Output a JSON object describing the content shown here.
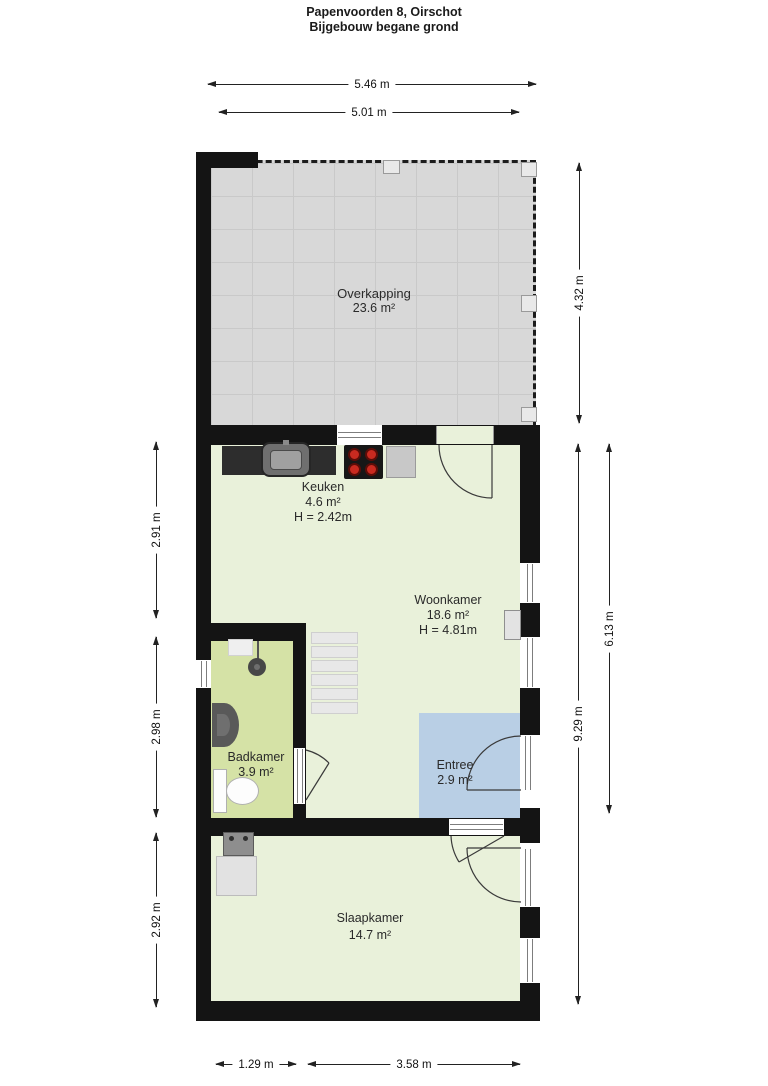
{
  "title": {
    "line1": "Papenvoorden 8, Oirschot",
    "line2": "Bijgebouw begane grond"
  },
  "rooms": {
    "overkapping": {
      "name": "Overkapping",
      "area": "23.6 m²"
    },
    "keuken": {
      "name": "Keuken",
      "area": "4.6 m²",
      "ceiling": "H = 2.42m"
    },
    "woonkamer": {
      "name": "Woonkamer",
      "area": "18.6 m²",
      "ceiling": "H = 4.81m"
    },
    "badkamer": {
      "name": "Badkamer",
      "area": "3.9 m²"
    },
    "entree": {
      "name": "Entree",
      "area": "2.9 m²"
    },
    "slaapkamer": {
      "name": "Slaapkamer",
      "area": "14.7 m²"
    }
  },
  "dimensions": {
    "width_total_top": "5.46 m",
    "width_overkapping": "5.01 m",
    "height_overkapping": "4.32 m",
    "height_keuken_zone": "2.91 m",
    "height_badkamer_zone": "2.98 m",
    "height_slaapkamer_zone": "2.92 m",
    "height_woonkamer_side": "6.13 m",
    "height_total_right": "9.29 m",
    "width_badkamer_bottom": "1.29 m",
    "width_slaapkamer_bottom": "3.58 m"
  },
  "colors": {
    "wall": "#141414",
    "room_green": "#e9f1da",
    "bathroom_green": "#d5e2a6",
    "entree_blue": "#b9cfe5",
    "overkapping_grey": "#d8d8d8",
    "burner_red": "#c92a20"
  },
  "fixtures": {
    "keuken": [
      "kitchen-sink",
      "stove",
      "appliance"
    ],
    "badkamer": [
      "shower",
      "washbasin",
      "toilet"
    ],
    "woonkamer": [
      "stairs",
      "radiator"
    ],
    "slaapkamer": [
      "washing-machine",
      "cabinet"
    ]
  }
}
